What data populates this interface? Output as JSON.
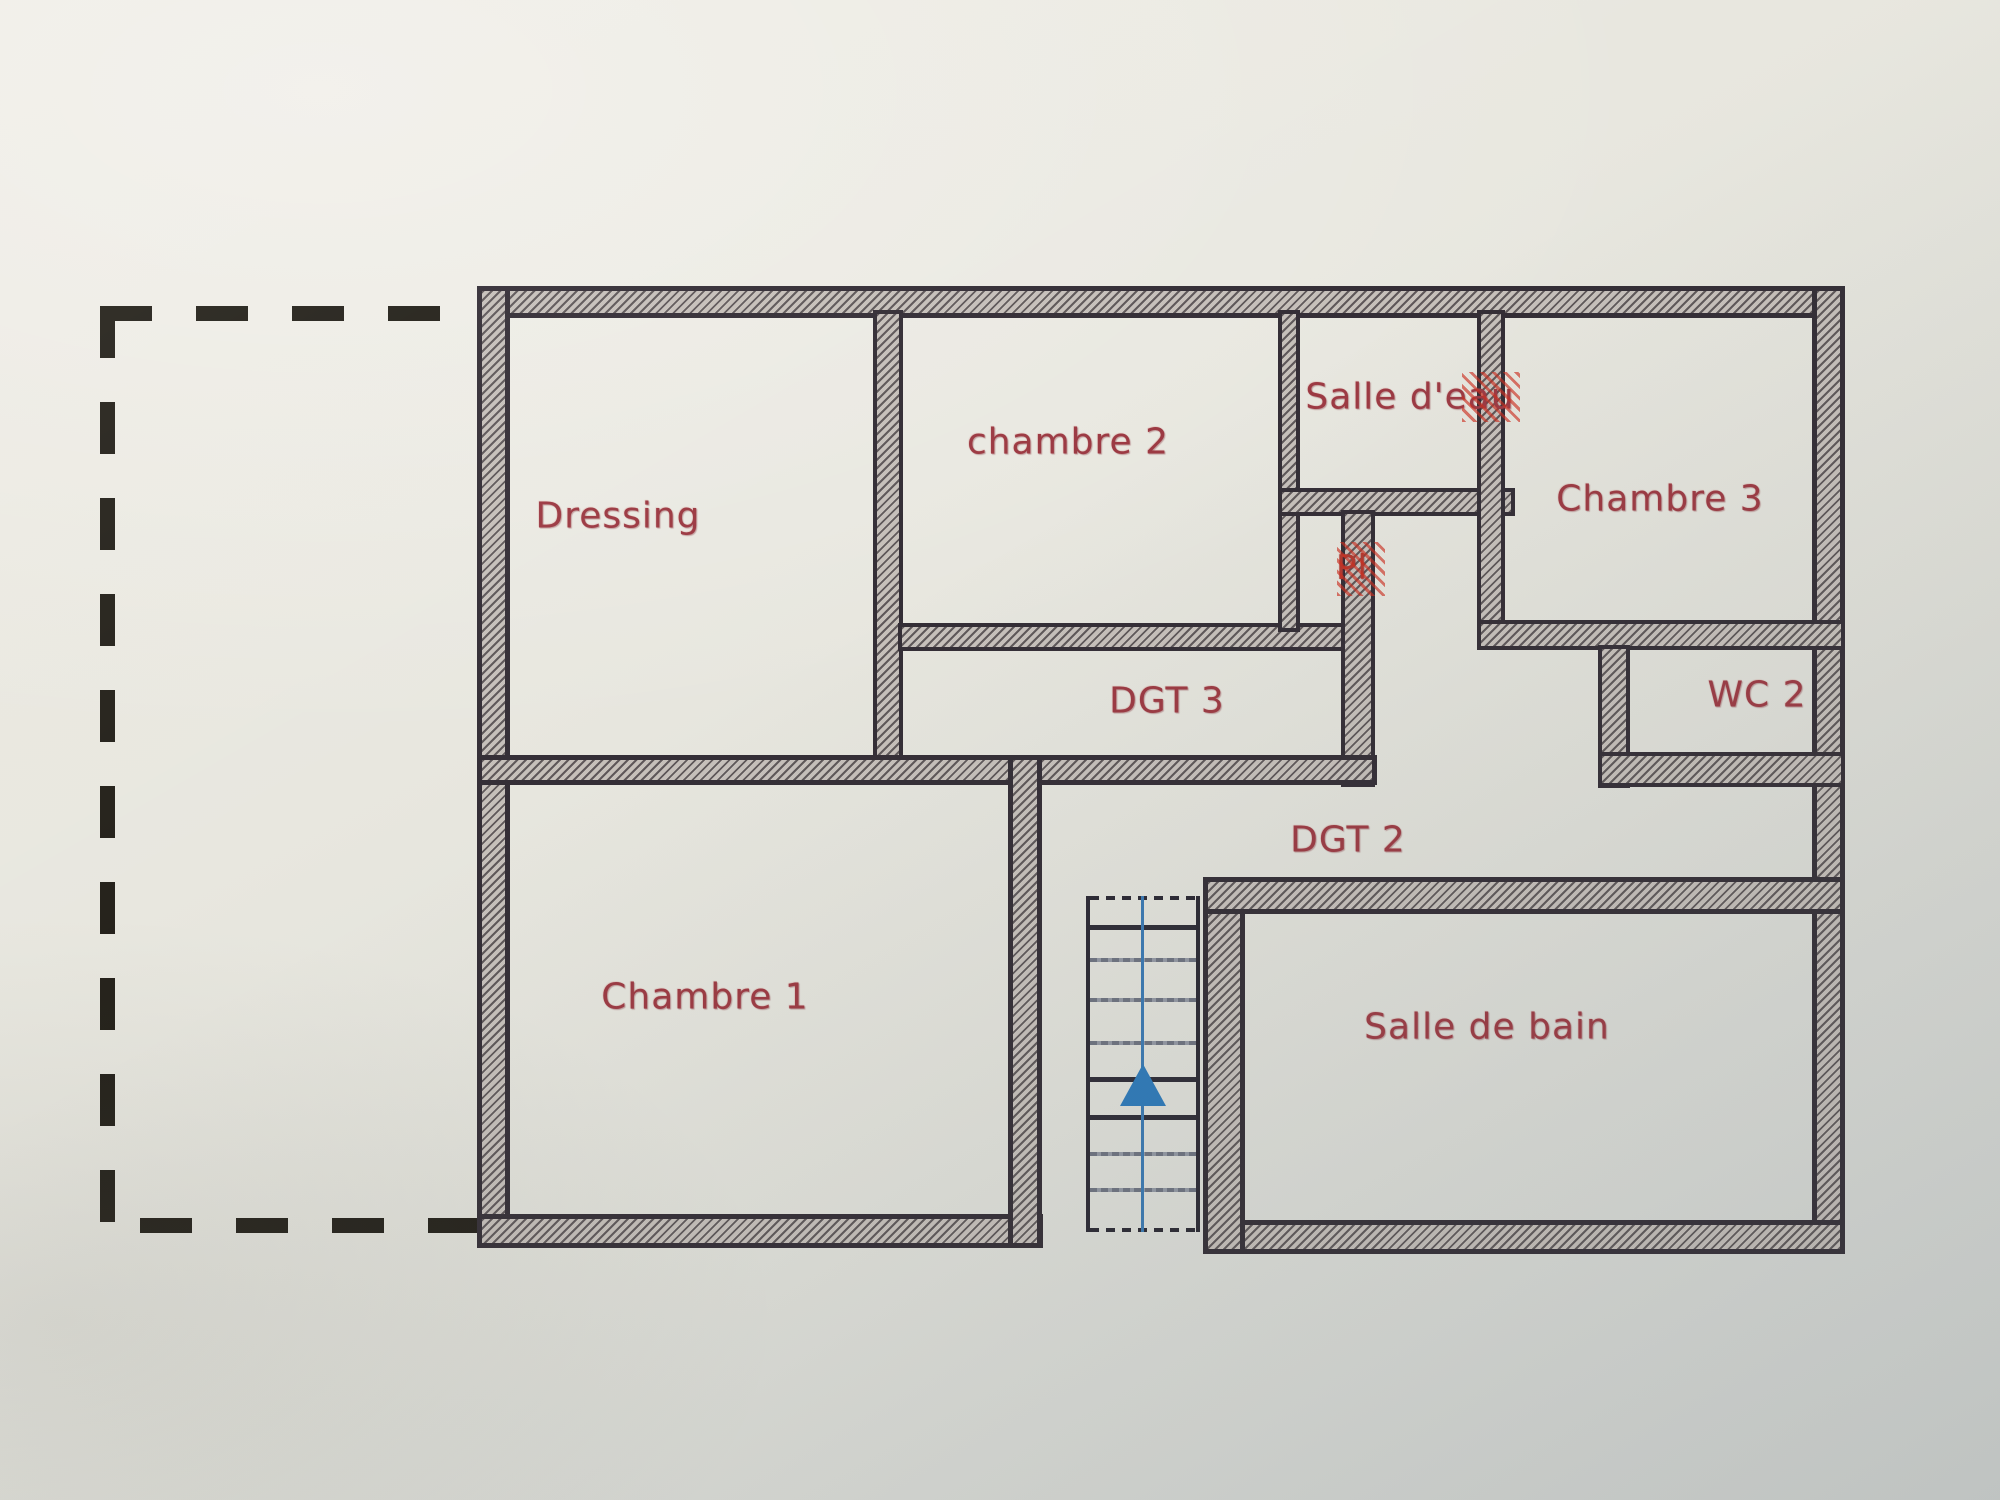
{
  "plan": {
    "type": "floor-plan",
    "rooms": {
      "dressing": {
        "label": "Dressing"
      },
      "chambre2": {
        "label": "chambre 2"
      },
      "salle_deau": {
        "label": "Salle d'eau"
      },
      "chambre3": {
        "label": "Chambre 3"
      },
      "placard": {
        "label": "Pl"
      },
      "dgt3": {
        "label": "DGT 3"
      },
      "wc2": {
        "label": "WC 2"
      },
      "dgt2": {
        "label": "DGT 2"
      },
      "chambre1": {
        "label": "Chambre 1"
      },
      "salle_de_bain": {
        "label": "Salle de bain"
      }
    },
    "stairs": {
      "direction": "up",
      "icon": "up-arrow-icon"
    },
    "colors": {
      "label_red": "#9c3a43",
      "accent_red": "#b2392f",
      "wall_dark": "#342e36",
      "wall_hatch": "#aea7a3",
      "arrow_blue": "#2e7ab9",
      "dash_black": "#232019",
      "paper": "#e8e7df"
    }
  }
}
